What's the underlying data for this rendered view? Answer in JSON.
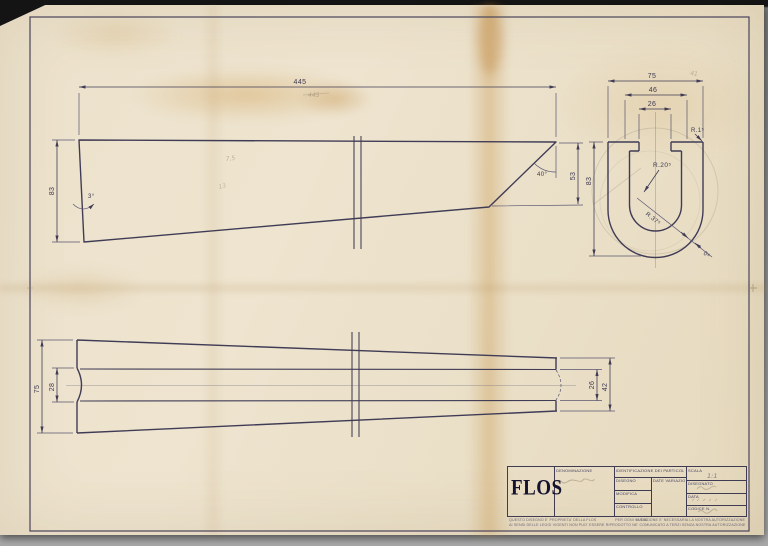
{
  "sheet": {
    "brand": "FLOS",
    "side_view": {
      "overall_length": "445",
      "height_left": "83",
      "height_right": "53",
      "cut_angle": "40°",
      "taper_angle": "3°"
    },
    "profile_view": {
      "width": "75",
      "opening": "46",
      "notch": "26",
      "height": "83",
      "corner_radius": "R.1⁵",
      "inner_radius": "R.20⁵",
      "outer_radius": "R.37⁵",
      "thickness": "0⁸"
    },
    "plan_view": {
      "width_left": "75",
      "slot_left": "28",
      "width_right": "42",
      "slot_right": "26"
    },
    "pencil_notes": {
      "length_note": "445",
      "mid_note_1": "7,5",
      "mid_note_2": "13",
      "width_note": "41",
      "scale_note": "1:1"
    },
    "title_block": {
      "denominazione_label": "DENOMINAZIONE",
      "identificazione_label": "IDENTIFICAZIONE DEI PARTICOLARI",
      "row1_label": "DISEGNO",
      "row2_label": "MODIFICA",
      "row3_label": "CONTROLLO",
      "variazione_label": "DATE VARIAZIONE",
      "scala_label": "SCALA",
      "disegnato_label": "DISEGNATO",
      "data_label": "DATA",
      "codice_label": "CODICE N.",
      "footer_left_1": "QUESTO DISEGNO E' PROPRIETA' DELLA FLOS",
      "footer_left_2": "AI SENSI DELLE LEGGI VIGENTI NON PUO' ESSERE RIPRODOTTO NE' COMUNICATO A TERZI SENZA NOSTRA AUTORIZZAZIONE",
      "footer_center": "N. DIS.",
      "footer_right": "PER OGNI VARIAZIONE E' NECESSARIA LA NOSTRA AUTORIZZAZIONE"
    }
  }
}
